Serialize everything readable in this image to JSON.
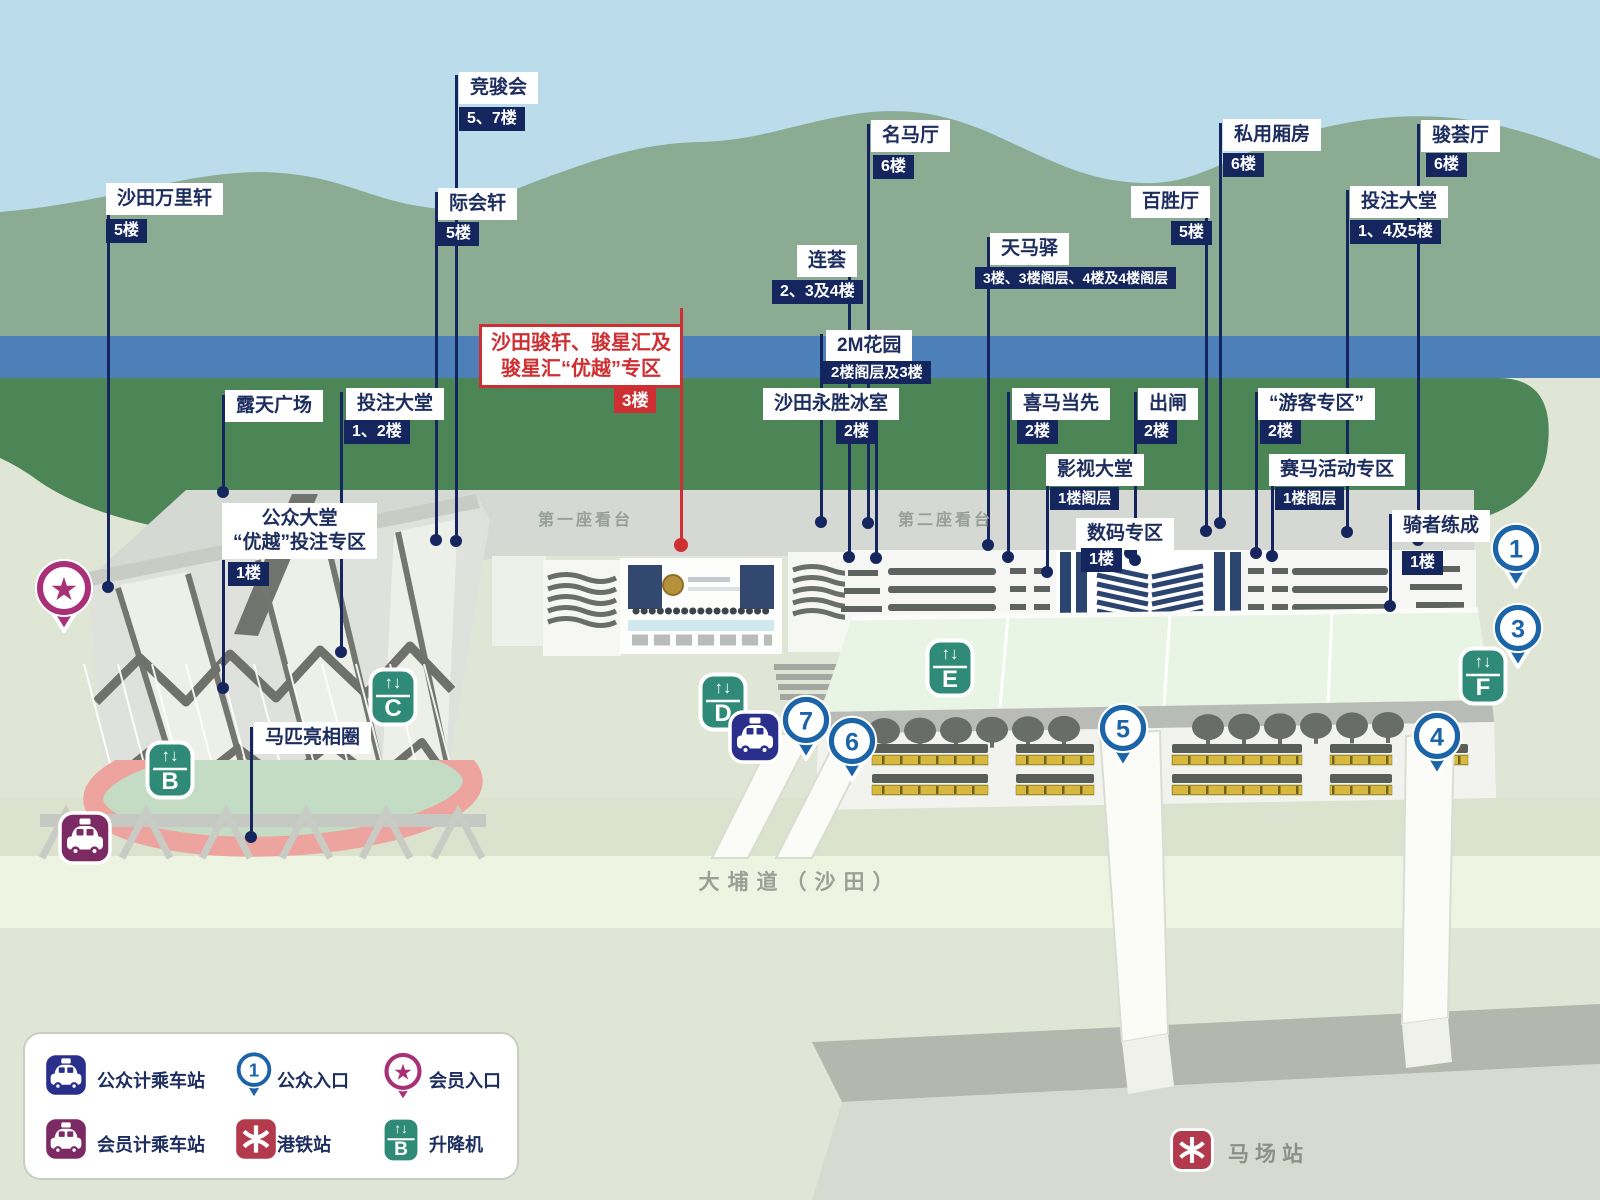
{
  "colors": {
    "navy": "#15265e",
    "red": "#ce2f33",
    "pin_blue": "#1b64a8",
    "lift_green": "#2f8b77",
    "taxi_public": "#2b2f8c",
    "taxi_member": "#7c2a64",
    "member_pink": "#a83077",
    "mtr_red": "#b23a4c"
  },
  "stands": {
    "stand1": "第一座看台",
    "stand2": "第二座看台"
  },
  "road": {
    "label": "大埔道（沙田）"
  },
  "station": {
    "label": "马场站"
  },
  "labels": [
    {
      "id": "shatin-trackside",
      "lines": [
        "沙田万里轩"
      ],
      "floor": "5楼",
      "box": [
        106,
        183
      ],
      "badge": [
        106,
        219
      ],
      "line": [
        108,
        186,
        587
      ]
    },
    {
      "id": "racing-club",
      "lines": [
        "竞骏会"
      ],
      "floor": "5、7楼",
      "box": [
        459,
        72
      ],
      "badge": [
        459,
        107
      ],
      "line": [
        456,
        75,
        541
      ]
    },
    {
      "id": "chik-wui-hin",
      "lines": [
        "际会轩"
      ],
      "floor": "5楼",
      "box": [
        438,
        188
      ],
      "badge": [
        438,
        222
      ],
      "line": [
        436,
        192,
        540
      ]
    },
    {
      "id": "open-piazza",
      "lines": [
        "露天广场"
      ],
      "floor": null,
      "box": [
        225,
        390
      ],
      "line": [
        223,
        395,
        492
      ]
    },
    {
      "id": "betting-hall-grandstand1",
      "lines": [
        "投注大堂"
      ],
      "floor": "1、2楼",
      "box": [
        346,
        388
      ],
      "badge": [
        344,
        420
      ],
      "line": [
        341,
        392,
        652
      ]
    },
    {
      "id": "public-hall-priority-zone",
      "lines": [
        "公众大堂",
        "“优越”投注专区"
      ],
      "floor": "1楼",
      "box": [
        222,
        503
      ],
      "badge": [
        228,
        562
      ],
      "line": [
        223,
        560,
        688
      ],
      "align": "center"
    },
    {
      "id": "parade-ring",
      "lines": [
        "马匹亮相圈"
      ],
      "floor": null,
      "box": [
        254,
        722
      ],
      "line": [
        251,
        727,
        837
      ]
    },
    {
      "id": "shatin-lodge-star-hub-priority",
      "lines": [
        "沙田骏轩、骏星汇及",
        "骏星汇“优越”专区"
      ],
      "floor": "3楼",
      "box": [
        479,
        324
      ],
      "badge": [
        614,
        388
      ],
      "line": [
        681,
        308,
        545
      ],
      "red": true,
      "align": "center"
    },
    {
      "id": "yung-sing-cafe",
      "lines": [
        "沙田永胜冰室"
      ],
      "floor": "2楼",
      "box": [
        763,
        388
      ],
      "badge": [
        836,
        420
      ],
      "line": [
        876,
        392,
        558
      ]
    },
    {
      "id": "ming-ma-hall",
      "lines": [
        "名马厅"
      ],
      "floor": "6楼",
      "box": [
        871,
        120
      ],
      "badge": [
        873,
        155
      ],
      "line": [
        868,
        124,
        523
      ]
    },
    {
      "id": "tin-ma-inn",
      "lines": [
        "天马驿"
      ],
      "floor": "3楼、3楼阁层、4楼及4楼阁层",
      "box": [
        990,
        233
      ],
      "badge": [
        975,
        267
      ],
      "badge_font": 14,
      "line": [
        988,
        237,
        545
      ]
    },
    {
      "id": "pak-sing-hall",
      "lines": [
        "百胜厅"
      ],
      "floor": "5楼",
      "box": [
        1131,
        186
      ],
      "badge": [
        1171,
        221
      ],
      "line": [
        1206,
        212,
        531
      ]
    },
    {
      "id": "private-boxes",
      "lines": [
        "私用厢房"
      ],
      "floor": "6楼",
      "box": [
        1223,
        119
      ],
      "badge": [
        1223,
        153
      ],
      "line": [
        1220,
        123,
        523
      ]
    },
    {
      "id": "tourists-zone",
      "lines": [
        "“游客专区”"
      ],
      "floor": "2楼",
      "box": [
        1258,
        388
      ],
      "badge": [
        1260,
        420
      ],
      "line": [
        1256,
        392,
        553
      ]
    },
    {
      "id": "racing-activity-zone",
      "lines": [
        "赛马活动专区"
      ],
      "floor": "1楼阁层",
      "box": [
        1269,
        454
      ],
      "badge": [
        1275,
        487
      ],
      "badge_font": 15,
      "line": [
        1272,
        458,
        556
      ]
    },
    {
      "id": "betting-hall-grandstand2",
      "lines": [
        "投注大堂"
      ],
      "floor": "1、4及5楼",
      "box": [
        1350,
        186
      ],
      "badge": [
        1350,
        220
      ],
      "line": [
        1347,
        190,
        532
      ]
    },
    {
      "id": "chun-wui-hall",
      "lines": [
        "骏荟厅"
      ],
      "floor": "6楼",
      "box": [
        1421,
        120
      ],
      "badge": [
        1426,
        153
      ],
      "line": [
        1418,
        124,
        540
      ]
    },
    {
      "id": "riders-up",
      "lines": [
        "骑者练成"
      ],
      "floor": "1楼",
      "box": [
        1392,
        510
      ],
      "badge": [
        1402,
        551
      ],
      "line": [
        1390,
        514,
        606
      ]
    },
    {
      "id": "movie-hall",
      "lines": [
        "影视大堂"
      ],
      "floor": "1楼阁层",
      "box": [
        1046,
        454
      ],
      "badge": [
        1050,
        487
      ],
      "badge_font": 15,
      "line": [
        1047,
        458,
        572
      ]
    },
    {
      "id": "digital-zone",
      "lines": [
        "数码专区"
      ],
      "floor": "1楼",
      "box": [
        1076,
        518
      ],
      "badge": [
        1081,
        548
      ],
      "line": [
        1130,
        522,
        553
      ]
    },
    {
      "id": "hi-ma-dong-sin",
      "lines": [
        "喜马当先"
      ],
      "floor": "2楼",
      "box": [
        1012,
        388
      ],
      "badge": [
        1017,
        420
      ],
      "line": [
        1008,
        392,
        557
      ]
    },
    {
      "id": "starting-gate",
      "lines": [
        "出闸"
      ],
      "floor": "2楼",
      "box": [
        1138,
        388
      ],
      "badge": [
        1136,
        420
      ],
      "line": [
        1135,
        392,
        560
      ]
    },
    {
      "id": "lin-wui",
      "lines": [
        "连荟"
      ],
      "floor": "2、3及4楼",
      "box": [
        797,
        245
      ],
      "badge": [
        772,
        280
      ],
      "line": [
        849,
        249,
        557
      ]
    },
    {
      "id": "2m-garden",
      "lines": [
        "2M花园"
      ],
      "floor": "2楼阁层及3楼",
      "box": [
        826,
        330
      ],
      "badge": [
        823,
        361
      ],
      "badge_font": 15,
      "line": [
        821,
        334,
        522
      ]
    }
  ],
  "entrances": [
    {
      "num": "1",
      "x": 1516,
      "y": 549
    },
    {
      "num": "3",
      "x": 1518,
      "y": 629
    },
    {
      "num": "4",
      "x": 1437,
      "y": 737
    },
    {
      "num": "5",
      "x": 1123,
      "y": 729
    },
    {
      "num": "6",
      "x": 852,
      "y": 742
    },
    {
      "num": "7",
      "x": 806,
      "y": 721
    }
  ],
  "lifts": [
    {
      "letter": "B",
      "x": 170,
      "y": 770
    },
    {
      "letter": "C",
      "x": 393,
      "y": 697
    },
    {
      "letter": "D",
      "x": 723,
      "y": 702
    },
    {
      "letter": "E",
      "x": 950,
      "y": 668
    },
    {
      "letter": "F",
      "x": 1483,
      "y": 676
    }
  ],
  "taxis": [
    {
      "type": "public",
      "x": 755,
      "y": 737
    },
    {
      "type": "member",
      "x": 85,
      "y": 838
    }
  ],
  "member_entrance": {
    "x": 64,
    "y": 588
  },
  "legend": {
    "items": [
      {
        "icon": "taxi-public",
        "label": "公众计乘车站"
      },
      {
        "icon": "entrance-pin",
        "icon_number": "1",
        "label": "公众入口"
      },
      {
        "icon": "member-entrance-pin",
        "label": "会员入口"
      },
      {
        "icon": "taxi-member",
        "label": "会员计乘车站"
      },
      {
        "icon": "mtr",
        "label": "港铁站"
      },
      {
        "icon": "lift",
        "icon_letter": "B",
        "label": "升降机"
      }
    ]
  }
}
